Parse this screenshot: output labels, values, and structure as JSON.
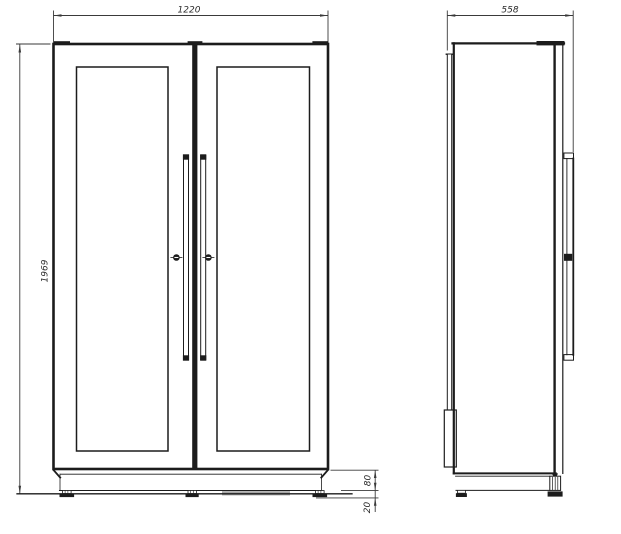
{
  "page": {
    "background": "#ffffff"
  },
  "drawing": {
    "kind": "cabinet-dimension-drawing",
    "front_view": {
      "width_mm": "1220",
      "height_mm": "1969",
      "plinth_height_mm": "80",
      "foot_clearance_mm": "20"
    },
    "side_view": {
      "depth_mm": "558"
    },
    "colors": {
      "line": "#1c1c1c",
      "dim_line": "#3a3a3a",
      "text": "#2b2b2b",
      "shade": "#8f8f8f"
    }
  }
}
